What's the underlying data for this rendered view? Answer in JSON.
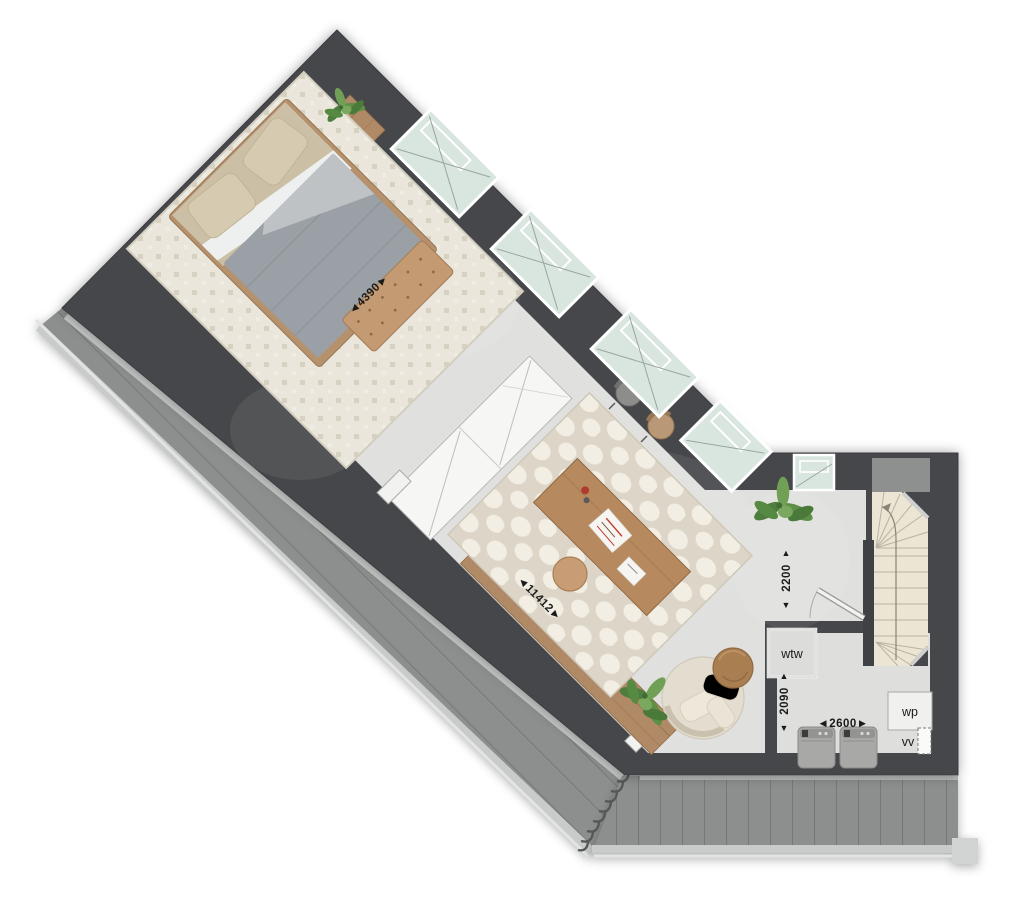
{
  "plan": {
    "dimension_labels": {
      "bed_area_width": "◄4390►",
      "room_length": "◄11412►",
      "hall_depth": "2200",
      "utility_depth": "2090",
      "utility_width": "◄2600►",
      "arrow_up": "▲",
      "arrow_down": "▼"
    },
    "equipment_labels": {
      "wtw": "wtw",
      "wp": "wp",
      "vv": "vv"
    },
    "colors": {
      "wall": "#45474a",
      "floor": "#e0e0de",
      "roof": "#8d8f8e",
      "wood": "#b08a66",
      "glass": "#d9e6e0",
      "stair_floor": "#ece5d4",
      "rug_bed": "#eae6dc",
      "rug_desk": "#ddd6c8",
      "duvet": "#9aa0a5",
      "bench": "#c49a72"
    }
  }
}
